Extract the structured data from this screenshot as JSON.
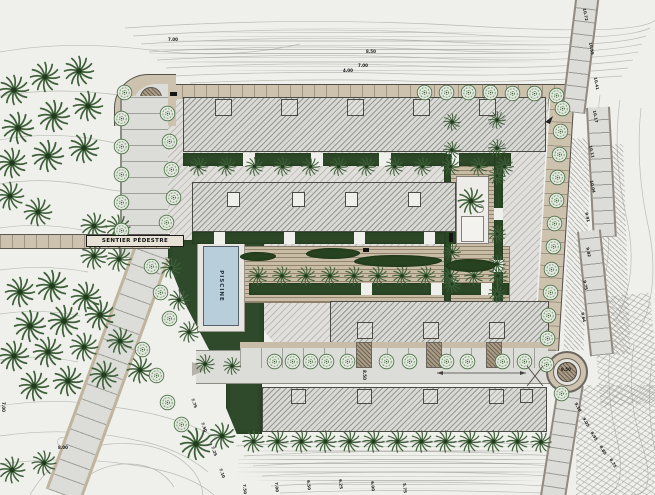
{
  "title": "Site plan – resort landscape layout",
  "labels": {
    "path": "SENTIER PÉDESTRE",
    "pool": "PISCINE"
  },
  "colors": {
    "background": "#efefec",
    "building_hatch": "#d8d8d5",
    "plaza_hatch": "#e0dfdb",
    "tan_paving": "#cdc2ae",
    "road_gray": "#dcdcd8",
    "deck_wood": "#c9bca6",
    "hedge_green": "#2c4827",
    "lawn_green": "#2e4a2a",
    "palm_green": "#3e6039",
    "pool_blue": "#b9cedb",
    "line_dark": "#4c4a45"
  },
  "annotations": [
    {
      "text": "7.00",
      "x": 168,
      "y": 38,
      "rot": 0
    },
    {
      "text": "8.50",
      "x": 366,
      "y": 50,
      "rot": 0
    },
    {
      "text": "7.00",
      "x": 358,
      "y": 64,
      "rot": 0
    },
    {
      "text": "4.00",
      "x": 343,
      "y": 69,
      "rot": 0
    },
    {
      "text": "10.72",
      "x": 586,
      "y": 8,
      "rot": 80
    },
    {
      "text": "10.55",
      "x": 592,
      "y": 42,
      "rot": 80
    },
    {
      "text": "10.41",
      "x": 597,
      "y": 77,
      "rot": 80
    },
    {
      "text": "10.17",
      "x": 596,
      "y": 110,
      "rot": 80
    },
    {
      "text": "10.11",
      "x": 592,
      "y": 145,
      "rot": 78
    },
    {
      "text": "10.04",
      "x": 593,
      "y": 180,
      "rot": 78
    },
    {
      "text": "9.91",
      "x": 588,
      "y": 212,
      "rot": 78
    },
    {
      "text": "9.82",
      "x": 589,
      "y": 247,
      "rot": 78
    },
    {
      "text": "9.75",
      "x": 586,
      "y": 280,
      "rot": 78
    },
    {
      "text": "9.64",
      "x": 584,
      "y": 312,
      "rot": 78
    },
    {
      "text": "9.50",
      "x": 561,
      "y": 368,
      "rot": 0
    },
    {
      "text": "8.50",
      "x": 366,
      "y": 370,
      "rot": 90
    },
    {
      "text": "9.10",
      "x": 577,
      "y": 402,
      "rot": 60
    },
    {
      "text": "9.05",
      "x": 585,
      "y": 417,
      "rot": 60
    },
    {
      "text": "8.95",
      "x": 593,
      "y": 431,
      "rot": 60
    },
    {
      "text": "8.85",
      "x": 602,
      "y": 445,
      "rot": 60
    },
    {
      "text": "8.75",
      "x": 612,
      "y": 458,
      "rot": 60
    },
    {
      "text": "7.75",
      "x": 194,
      "y": 398,
      "rot": 70
    },
    {
      "text": "7.50",
      "x": 204,
      "y": 422,
      "rot": 70
    },
    {
      "text": "7.25",
      "x": 214,
      "y": 446,
      "rot": 70
    },
    {
      "text": "7.10",
      "x": 222,
      "y": 468,
      "rot": 70
    },
    {
      "text": "7.50",
      "x": 246,
      "y": 484,
      "rot": 85
    },
    {
      "text": "7.00",
      "x": 278,
      "y": 482,
      "rot": 85
    },
    {
      "text": "6.50",
      "x": 310,
      "y": 480,
      "rot": 85
    },
    {
      "text": "6.25",
      "x": 342,
      "y": 479,
      "rot": 85
    },
    {
      "text": "6.00",
      "x": 374,
      "y": 481,
      "rot": 85
    },
    {
      "text": "5.75",
      "x": 406,
      "y": 483,
      "rot": 85
    },
    {
      "text": "8.00",
      "x": 58,
      "y": 446,
      "rot": 0
    },
    {
      "text": "7.00",
      "x": 5,
      "y": 402,
      "rot": 90
    }
  ],
  "plan": {
    "palms": [
      [
        14,
        90,
        34
      ],
      [
        45,
        77,
        34
      ],
      [
        79,
        71,
        34
      ],
      [
        18,
        128,
        36
      ],
      [
        54,
        116,
        36
      ],
      [
        88,
        106,
        34
      ],
      [
        12,
        163,
        34
      ],
      [
        48,
        156,
        36
      ],
      [
        84,
        148,
        34
      ],
      [
        10,
        196,
        32
      ],
      [
        38,
        212,
        32
      ],
      [
        94,
        226,
        30
      ],
      [
        118,
        227,
        28
      ],
      [
        94,
        256,
        30
      ],
      [
        119,
        259,
        28
      ],
      [
        20,
        292,
        34
      ],
      [
        52,
        286,
        36
      ],
      [
        86,
        297,
        34
      ],
      [
        30,
        326,
        36
      ],
      [
        64,
        321,
        36
      ],
      [
        100,
        315,
        34
      ],
      [
        14,
        356,
        34
      ],
      [
        48,
        352,
        34
      ],
      [
        84,
        347,
        32
      ],
      [
        120,
        341,
        30
      ],
      [
        34,
        386,
        34
      ],
      [
        68,
        381,
        34
      ],
      [
        104,
        375,
        32
      ],
      [
        140,
        370,
        30
      ],
      [
        12,
        470,
        30
      ],
      [
        44,
        463,
        28
      ],
      [
        196,
        444,
        36
      ],
      [
        222,
        436,
        30
      ],
      [
        253,
        441,
        25
      ],
      [
        277,
        441,
        25
      ],
      [
        301,
        441,
        25
      ],
      [
        325,
        441,
        25
      ],
      [
        349,
        441,
        25
      ],
      [
        373,
        441,
        25
      ],
      [
        397,
        441,
        25
      ],
      [
        421,
        441,
        25
      ],
      [
        445,
        441,
        25
      ],
      [
        469,
        441,
        25
      ],
      [
        493,
        441,
        25
      ],
      [
        517,
        441,
        25
      ],
      [
        541,
        442,
        24
      ],
      [
        198,
        166,
        21
      ],
      [
        226,
        166,
        21
      ],
      [
        254,
        166,
        21
      ],
      [
        282,
        166,
        21
      ],
      [
        310,
        166,
        21
      ],
      [
        338,
        166,
        21
      ],
      [
        366,
        166,
        21
      ],
      [
        394,
        166,
        21
      ],
      [
        422,
        166,
        21
      ],
      [
        450,
        166,
        21
      ],
      [
        478,
        166,
        21
      ],
      [
        504,
        166,
        21
      ],
      [
        258,
        276,
        22
      ],
      [
        282,
        276,
        22
      ],
      [
        306,
        276,
        22
      ],
      [
        330,
        276,
        22
      ],
      [
        354,
        276,
        22
      ],
      [
        378,
        276,
        22
      ],
      [
        402,
        276,
        22
      ],
      [
        426,
        276,
        22
      ],
      [
        450,
        276,
        22
      ],
      [
        474,
        276,
        22
      ],
      [
        498,
        276,
        22
      ],
      [
        452,
        122,
        20
      ],
      [
        452,
        150,
        20
      ],
      [
        497,
        120,
        20
      ],
      [
        497,
        148,
        20
      ],
      [
        497,
        176,
        20
      ],
      [
        452,
        252,
        20
      ],
      [
        452,
        284,
        20
      ],
      [
        497,
        234,
        20
      ],
      [
        497,
        264,
        20
      ],
      [
        497,
        294,
        20
      ],
      [
        471,
        201,
        30
      ],
      [
        171,
        268,
        24
      ],
      [
        179,
        300,
        24
      ],
      [
        189,
        332,
        24
      ],
      [
        205,
        364,
        22
      ],
      [
        232,
        366,
        20
      ]
    ],
    "round_trees": [
      [
        121,
        118
      ],
      [
        121,
        146
      ],
      [
        121,
        174
      ],
      [
        121,
        202
      ],
      [
        121,
        230
      ],
      [
        167,
        113
      ],
      [
        169,
        141
      ],
      [
        171,
        169
      ],
      [
        173,
        197
      ],
      [
        166,
        222
      ],
      [
        124,
        92
      ],
      [
        151,
        266
      ],
      [
        160,
        292
      ],
      [
        169,
        318
      ],
      [
        142,
        349
      ],
      [
        156,
        375
      ],
      [
        167,
        402
      ],
      [
        181,
        424
      ],
      [
        424,
        92
      ],
      [
        446,
        92
      ],
      [
        468,
        92
      ],
      [
        490,
        92
      ],
      [
        512,
        93
      ],
      [
        534,
        93
      ],
      [
        556,
        95
      ],
      [
        562,
        108
      ],
      [
        560,
        131
      ],
      [
        559,
        154
      ],
      [
        557,
        177
      ],
      [
        556,
        200
      ],
      [
        554,
        223
      ],
      [
        553,
        246
      ],
      [
        551,
        269
      ],
      [
        550,
        292
      ],
      [
        548,
        315
      ],
      [
        547,
        338
      ],
      [
        274,
        361
      ],
      [
        292,
        361
      ],
      [
        310,
        361
      ],
      [
        326,
        361
      ],
      [
        347,
        361
      ],
      [
        386,
        361
      ],
      [
        409,
        361
      ],
      [
        446,
        361
      ],
      [
        467,
        361
      ],
      [
        502,
        361
      ],
      [
        524,
        361
      ],
      [
        546,
        364
      ],
      [
        561,
        393
      ]
    ],
    "shrubs": [
      [
        306,
        248,
        54,
        11
      ],
      [
        354,
        255,
        88,
        12
      ],
      [
        446,
        259,
        50,
        13
      ],
      [
        240,
        252,
        36,
        9
      ]
    ]
  }
}
